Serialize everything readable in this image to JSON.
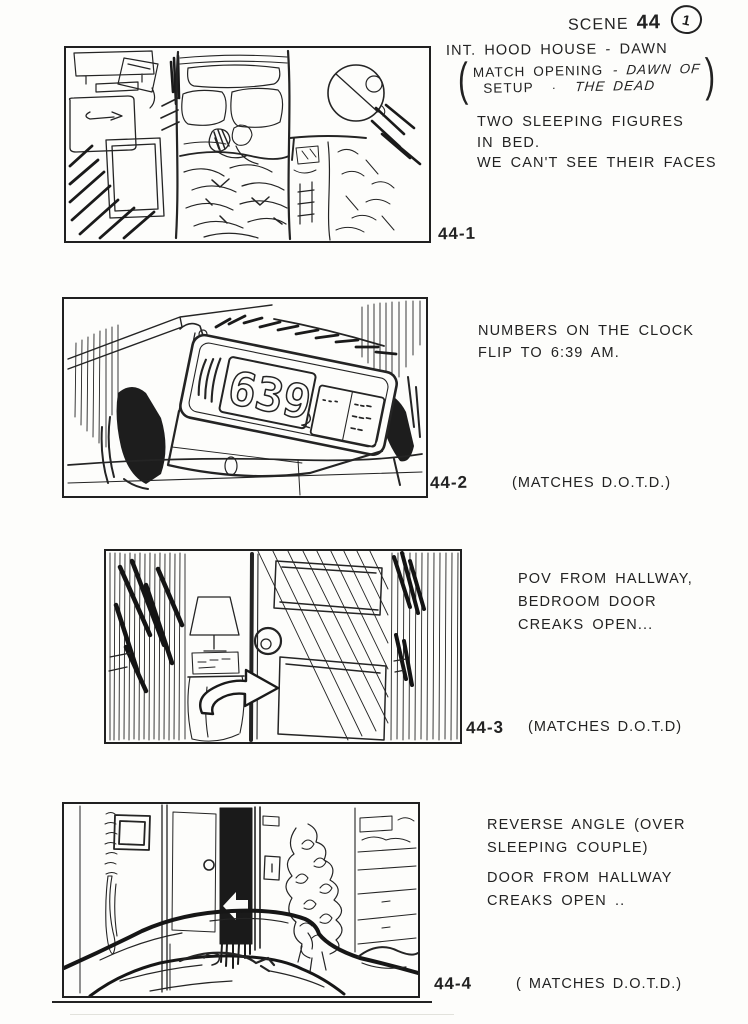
{
  "colors": {
    "ink": "#222222",
    "paper": "#fdfdfb"
  },
  "header": {
    "scene_word": "SCENE",
    "scene_number": "44",
    "page_number": "1"
  },
  "shot1": {
    "heading": "INT. HOOD HOUSE - DAWN",
    "paren": {
      "open": "(",
      "r1a": "MATCH OPENING",
      "r1b": "- DAWN OF",
      "r2a": "SETUP",
      "dot": "·",
      "r2b": "THE DEAD",
      "close": ")"
    },
    "lines": [
      "TWO SLEEPING FIGURES",
      "IN BED.",
      "WE CAN'T SEE THEIR FACES"
    ],
    "label": "44-1"
  },
  "shot2": {
    "lines": [
      "NUMBERS ON THE CLOCK",
      "FLIP TO 6:39 AM."
    ],
    "label": "44-2",
    "match_note": "(MATCHES D.O.T.D.)",
    "clock_digits": "639"
  },
  "shot3": {
    "lines": [
      "POV FROM HALLWAY,",
      "BEDROOM DOOR",
      "CREAKS OPEN..."
    ],
    "label": "44-3",
    "match_note": "(MATCHES D.O.T.D)"
  },
  "shot4": {
    "lines_a": [
      "REVERSE ANGLE (OVER",
      "SLEEPING COUPLE)"
    ],
    "lines_b": [
      "DOOR FROM HALLWAY",
      "CREAKS OPEN .."
    ],
    "label": "44-4",
    "match_note": "( MATCHES D.O.T.D.)"
  }
}
